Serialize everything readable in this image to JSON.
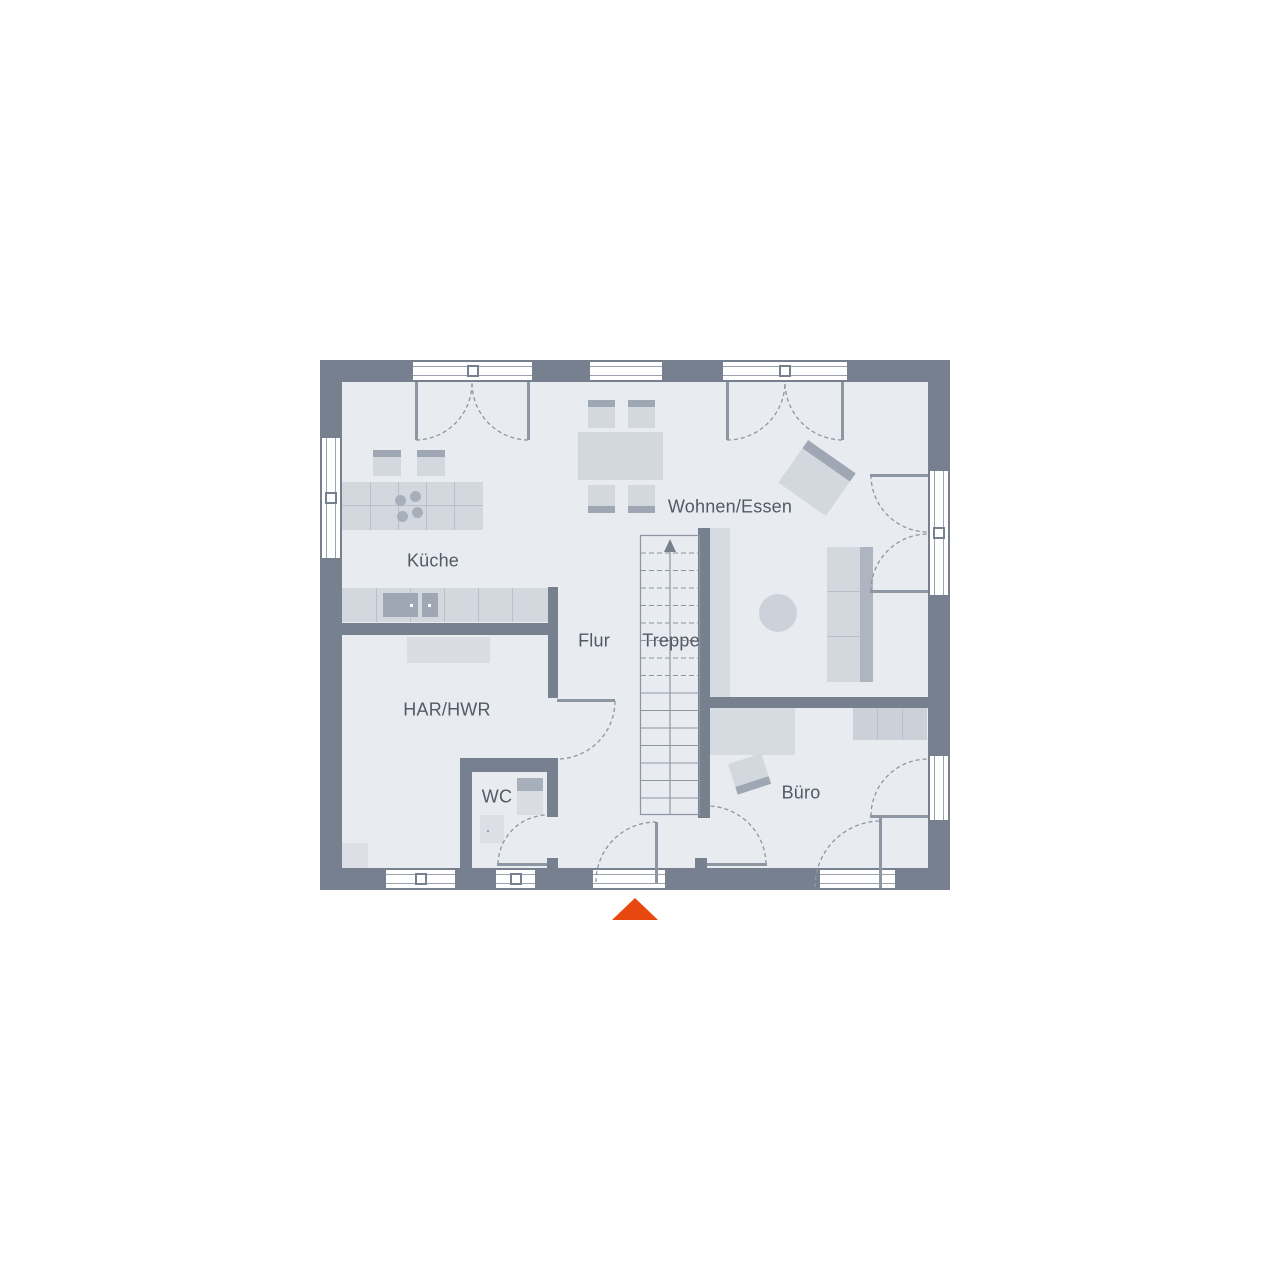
{
  "rooms": {
    "kueche": {
      "label": "Küche"
    },
    "wohnen_essen": {
      "label": "Wohnen/Essen"
    },
    "flur": {
      "label": "Flur"
    },
    "treppe": {
      "label": "Treppe"
    },
    "har_hwr": {
      "label": "HAR/HWR"
    },
    "wc": {
      "label": "WC"
    },
    "buero": {
      "label": "Büro"
    }
  },
  "icons": {
    "entrance_marker": "triangle-up",
    "stairs_direction": "arrow-up"
  },
  "colors": {
    "wall": "#76808f",
    "floor": "#e8ebf0",
    "furniture": "#d3d8df",
    "furniture_dark": "#9ea7b3",
    "outline": "#8e96a3",
    "frame": "#9aa2ae",
    "label": "#525a66",
    "entrance": "#e8470f"
  }
}
